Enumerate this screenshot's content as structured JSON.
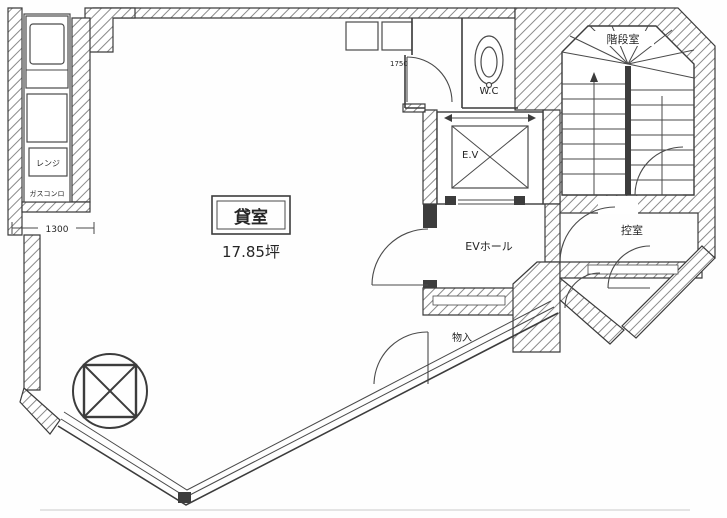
{
  "document": {
    "type": "floor-plan",
    "style": "scanned architectural drawing, black line art on white"
  },
  "labels": {
    "main_room": "貸室",
    "main_room_area": "17.85坪",
    "ev_hall": "EVホール",
    "elevator": "E.V",
    "wc": "W.C",
    "stairwell": "階段室",
    "anteroom": "控室",
    "storage": "物入",
    "range": "レンジ",
    "gas_stove": "ガスコンロ"
  },
  "dimensions": {
    "kitchen_width_mm": "1300",
    "entry_width_mm": "1750"
  },
  "icons": {
    "column_symbol": "circle-with-crossed-square",
    "toilet_symbol": "oval-toilet",
    "elevator_symbol": "crossed-box",
    "stairs_symbol": "treads-with-winders"
  },
  "colors": {
    "line": "#3c3c3c",
    "hatch": "#8a8a8a",
    "paper": "#fefefe"
  }
}
